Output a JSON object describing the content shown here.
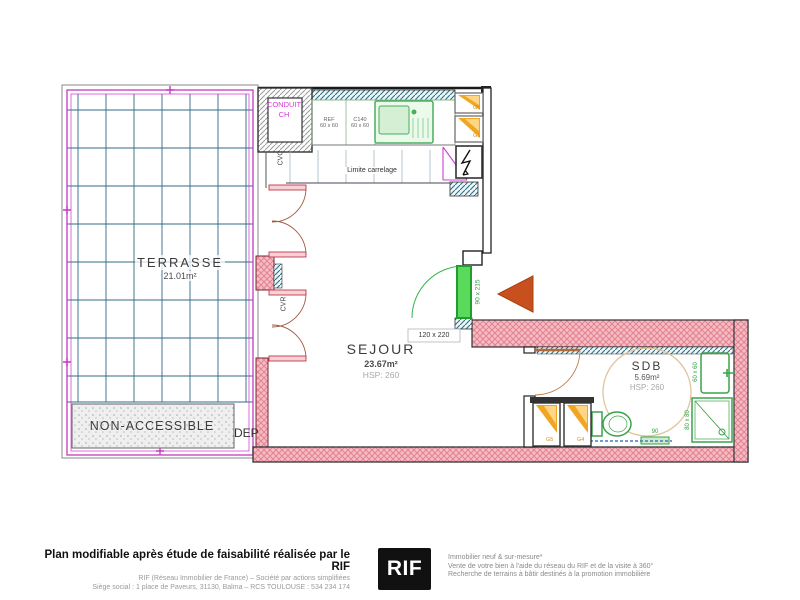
{
  "plan": {
    "terrasse": {
      "label": "TERRASSE",
      "area": "21.01m²"
    },
    "sejour": {
      "label": "SEJOUR",
      "area": "23.67m²",
      "height": "HSP: 260"
    },
    "sdb": {
      "label": "SDB",
      "area": "5.69m²",
      "height": "HSP: 260"
    },
    "non_accessible_label": "NON-ACCESSIBLE",
    "dep_label": "DEP",
    "conduit_line1": "CONDUIT",
    "conduit_line2": "CH",
    "cvc_label": "CVC",
    "cvr_label": "CVR",
    "limite_carrelage_label": "Limite carrelage",
    "kitchen_units": [
      {
        "name": "REF",
        "size": "60 x 60"
      },
      {
        "name": "C140",
        "size": "60 x 60"
      }
    ],
    "dims": {
      "entry_window": "120 x 220",
      "entry_door": "90 x 215",
      "radiator": "60 x 60",
      "shower": "80 x 80",
      "wc": "90"
    },
    "cabinets": {
      "g6": "G6",
      "g1": "G1",
      "g5": "G5",
      "g4": "G4"
    }
  },
  "footer": {
    "left_title": "Plan modifiable après étude de faisabilité réalisée par le RIF",
    "left_line2": "RIF (Réseau Immobilier de France) – Société par actions simplifiées",
    "left_line3": "Siège social : 1 place de Paveurs, 31130, Balma – RCS TOULOUSE : 534 234 174",
    "logo_text": "RIF",
    "right_line1": "Immobilier neuf & sur-mesure*",
    "right_line2": "Vente de votre bien à l'aide du réseau du RIF et de la visite à 360°",
    "right_line3": "Recherche de terrains à bâtir destinés à la promotion immobilière"
  },
  "colors": {
    "boundary_magenta": "#c837c8",
    "wall_pink": "#f6bcc6",
    "fixture_green": "#3aa34a",
    "entry_arrow_orange": "#c8501e",
    "grid_teal": "#2f6b85",
    "logo_bg": "#111111"
  }
}
